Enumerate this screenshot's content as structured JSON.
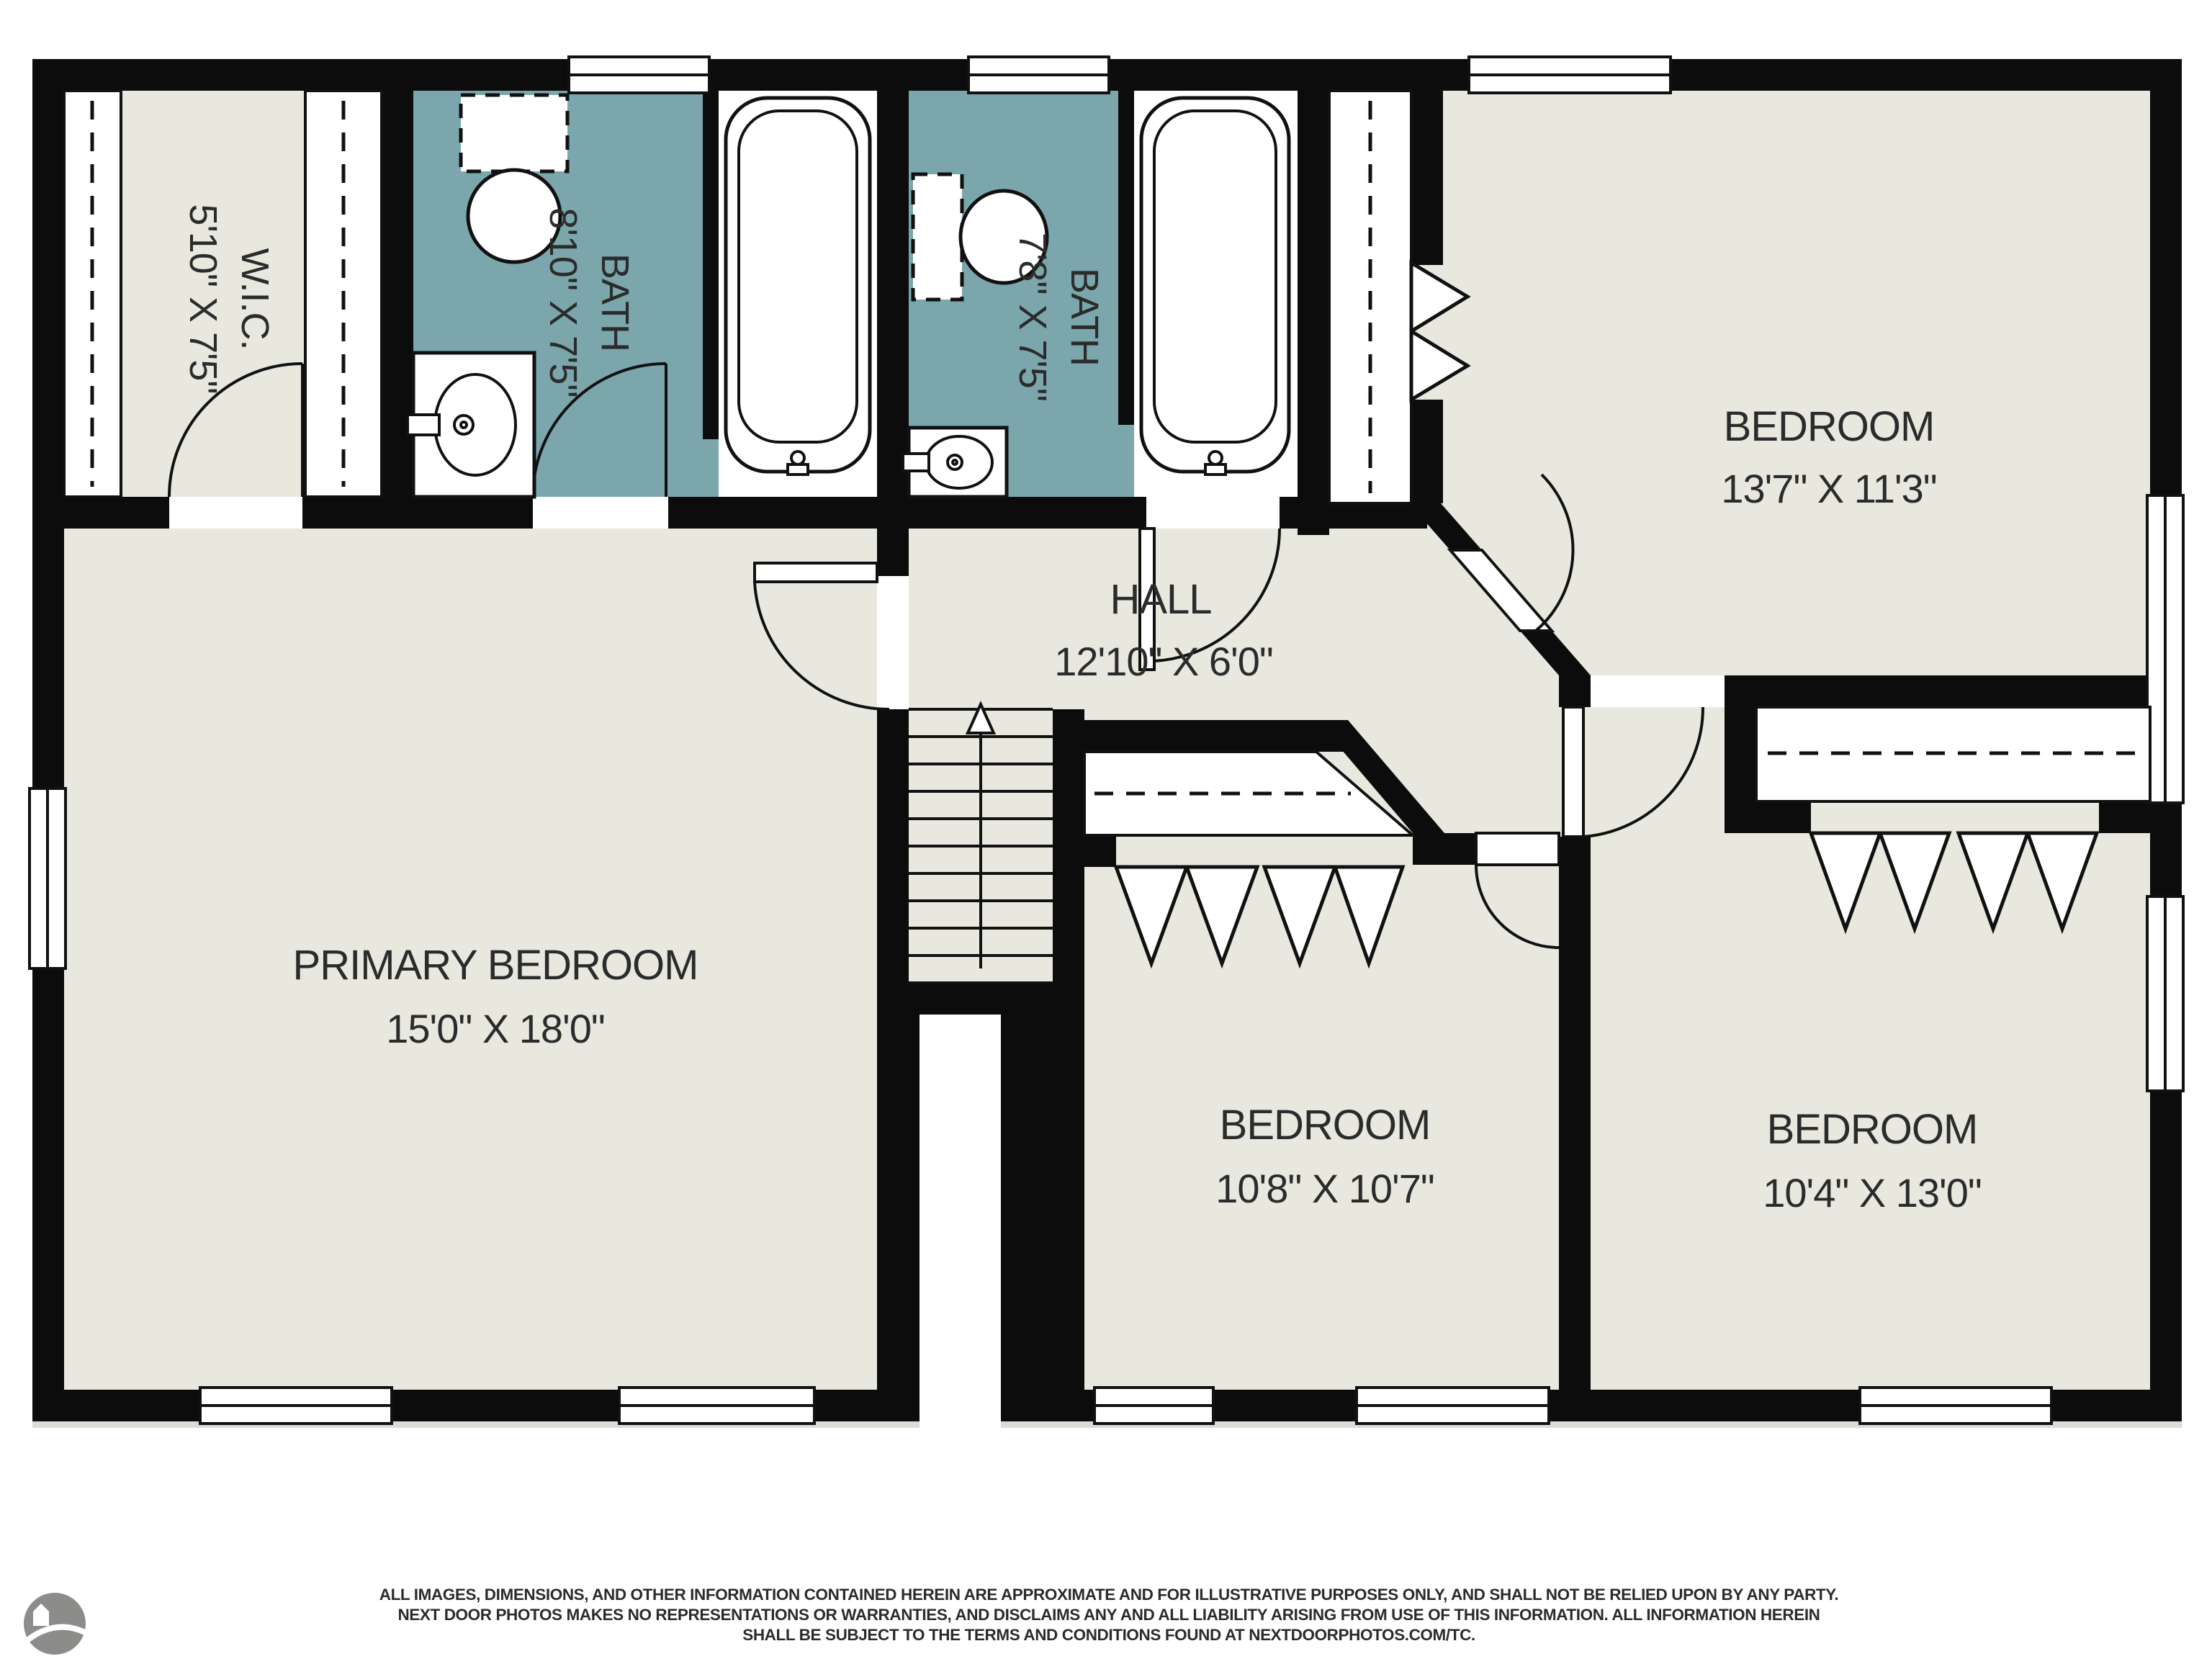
{
  "title": "Second floor residential floor plan",
  "colors": {
    "background": "#ffffff",
    "floor": "#e9e8de",
    "bath_floor": "#7ba6ac",
    "walls": "#0c0c0c",
    "text": "#2b2b2b",
    "logo_gray": "#8c8c8a"
  },
  "rooms": [
    {
      "id": "wic",
      "name": "W.I.C.",
      "dims": "5'10\" X 7'5\"",
      "label_rotated": true
    },
    {
      "id": "bath1",
      "name": "BATH",
      "dims": "8'10\" X 7'5\"",
      "label_rotated": true
    },
    {
      "id": "bath2",
      "name": "BATH",
      "dims": "7'8\" X 7'5\"",
      "label_rotated": true
    },
    {
      "id": "bedroom_top_right",
      "name": "BEDROOM",
      "dims": "13'7\" X 11'3\"",
      "label_rotated": false
    },
    {
      "id": "hall",
      "name": "HALL",
      "dims": "12'10\" X 6'0\"",
      "label_rotated": false
    },
    {
      "id": "primary_bedroom",
      "name": "PRIMARY BEDROOM",
      "dims": "15'0\" X 18'0\"",
      "label_rotated": false
    },
    {
      "id": "bedroom_center",
      "name": "BEDROOM",
      "dims": "10'8\" X 10'7\"",
      "label_rotated": false
    },
    {
      "id": "bedroom_bottom_right",
      "name": "BEDROOM",
      "dims": "10'4\" X 13'0\"",
      "label_rotated": false
    }
  ],
  "fixtures": [
    "toilet",
    "bathtub",
    "sink-vanity",
    "closet-rod",
    "bifold-door",
    "staircase",
    "stair-direction-arrow",
    "door-swing",
    "window"
  ],
  "footer": {
    "lines": [
      "ALL IMAGES, DIMENSIONS, AND OTHER INFORMATION CONTAINED HEREIN ARE APPROXIMATE AND FOR ILLUSTRATIVE PURPOSES ONLY, AND SHALL NOT BE RELIED UPON BY ANY PARTY.",
      "NEXT DOOR PHOTOS MAKES NO REPRESENTATIONS OR WARRANTIES, AND DISCLAIMS ANY AND ALL LIABILITY ARISING FROM USE OF THIS INFORMATION. ALL INFORMATION HEREIN",
      "SHALL BE SUBJECT TO THE TERMS AND CONDITIONS FOUND AT NEXTDOORPHOTOS.COM/TC."
    ]
  },
  "logo": {
    "name": "photo-company-circle-logo"
  }
}
